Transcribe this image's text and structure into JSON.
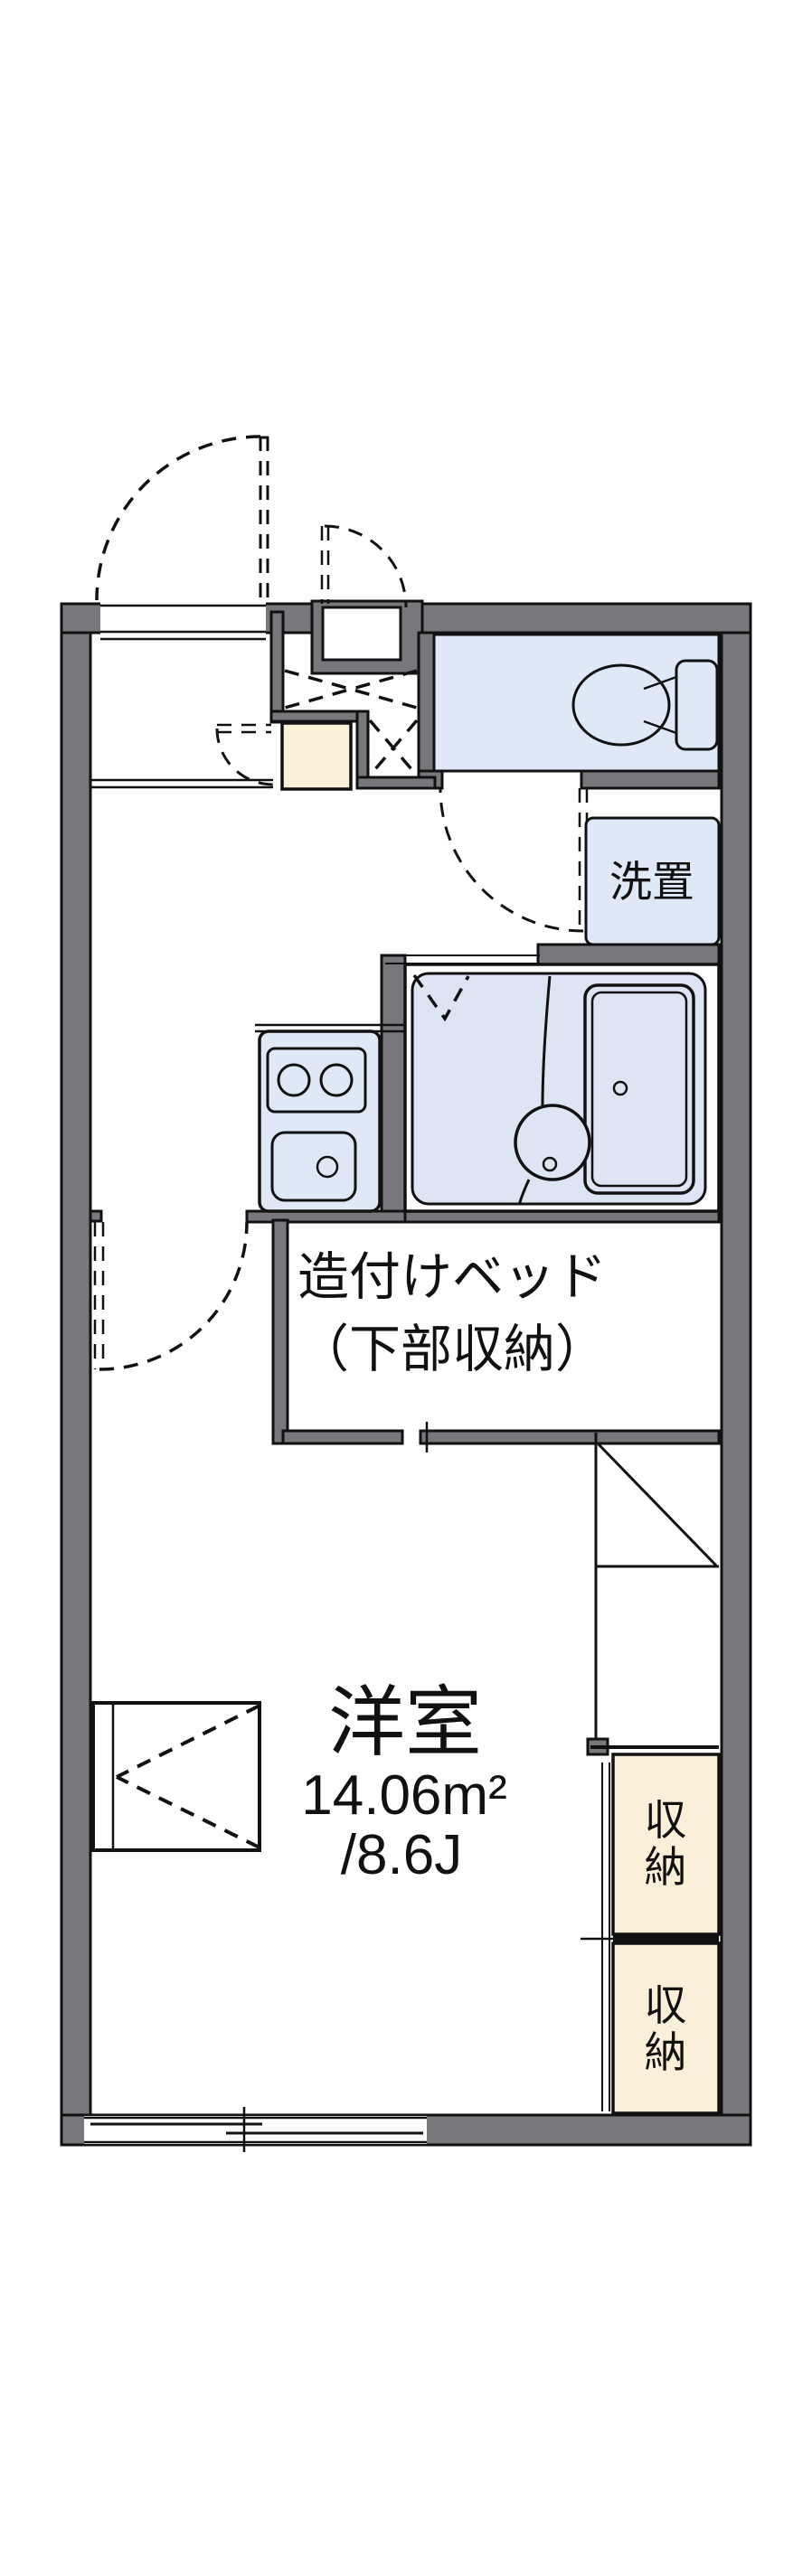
{
  "plan": {
    "type": "apartment-floor-plan",
    "labels": {
      "room_name": "洋室",
      "room_area_m2": "14.06m²",
      "room_area_tatami": "/8.6J",
      "bed_line1": "造付けベッド",
      "bed_line2": "（下部収納）",
      "laundry": "洗置",
      "storage_upper": "収納",
      "storage_lower": "収納"
    },
    "colors": {
      "wall": "#78787c",
      "plumbing": "#dfe8f7",
      "bath_floor": "#dde4f4",
      "storage": "#faf0da",
      "outline": "#111111",
      "background": "#ffffff"
    }
  }
}
